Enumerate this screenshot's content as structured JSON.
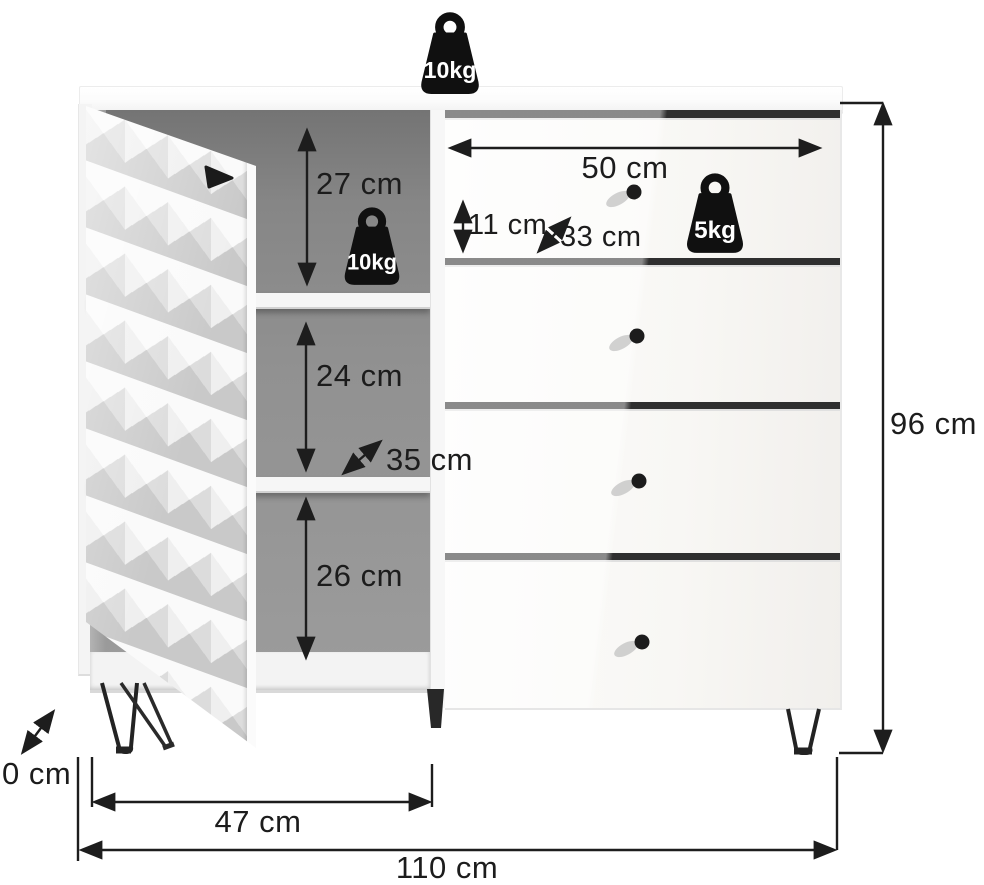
{
  "diagram": {
    "type": "furniture-dimension-diagram",
    "product": "sideboard with 3D-pattern door, two open shelf compartments and four drawers"
  },
  "labels": {
    "compartment_top_height": "27 cm",
    "compartment_middle_height": "24 cm",
    "compartment_bottom_height": "26 cm",
    "shelf_depth": "35 cm",
    "drawer_width": "50 cm",
    "drawer_front_height": "11 cm",
    "drawer_depth": "33 cm",
    "overall_height": "96 cm",
    "leg_clearance": "0 cm",
    "door_section_width": "47 cm",
    "overall_width": "110 cm"
  },
  "capacities": {
    "top_surface": "10kg",
    "shelf": "10kg",
    "drawer": "5kg"
  },
  "colors": {
    "line": "#1d1d1d",
    "interior_back": "#8d8d8d",
    "weight_icon": "#101010",
    "drawer_gap": "#2f2f2f"
  }
}
